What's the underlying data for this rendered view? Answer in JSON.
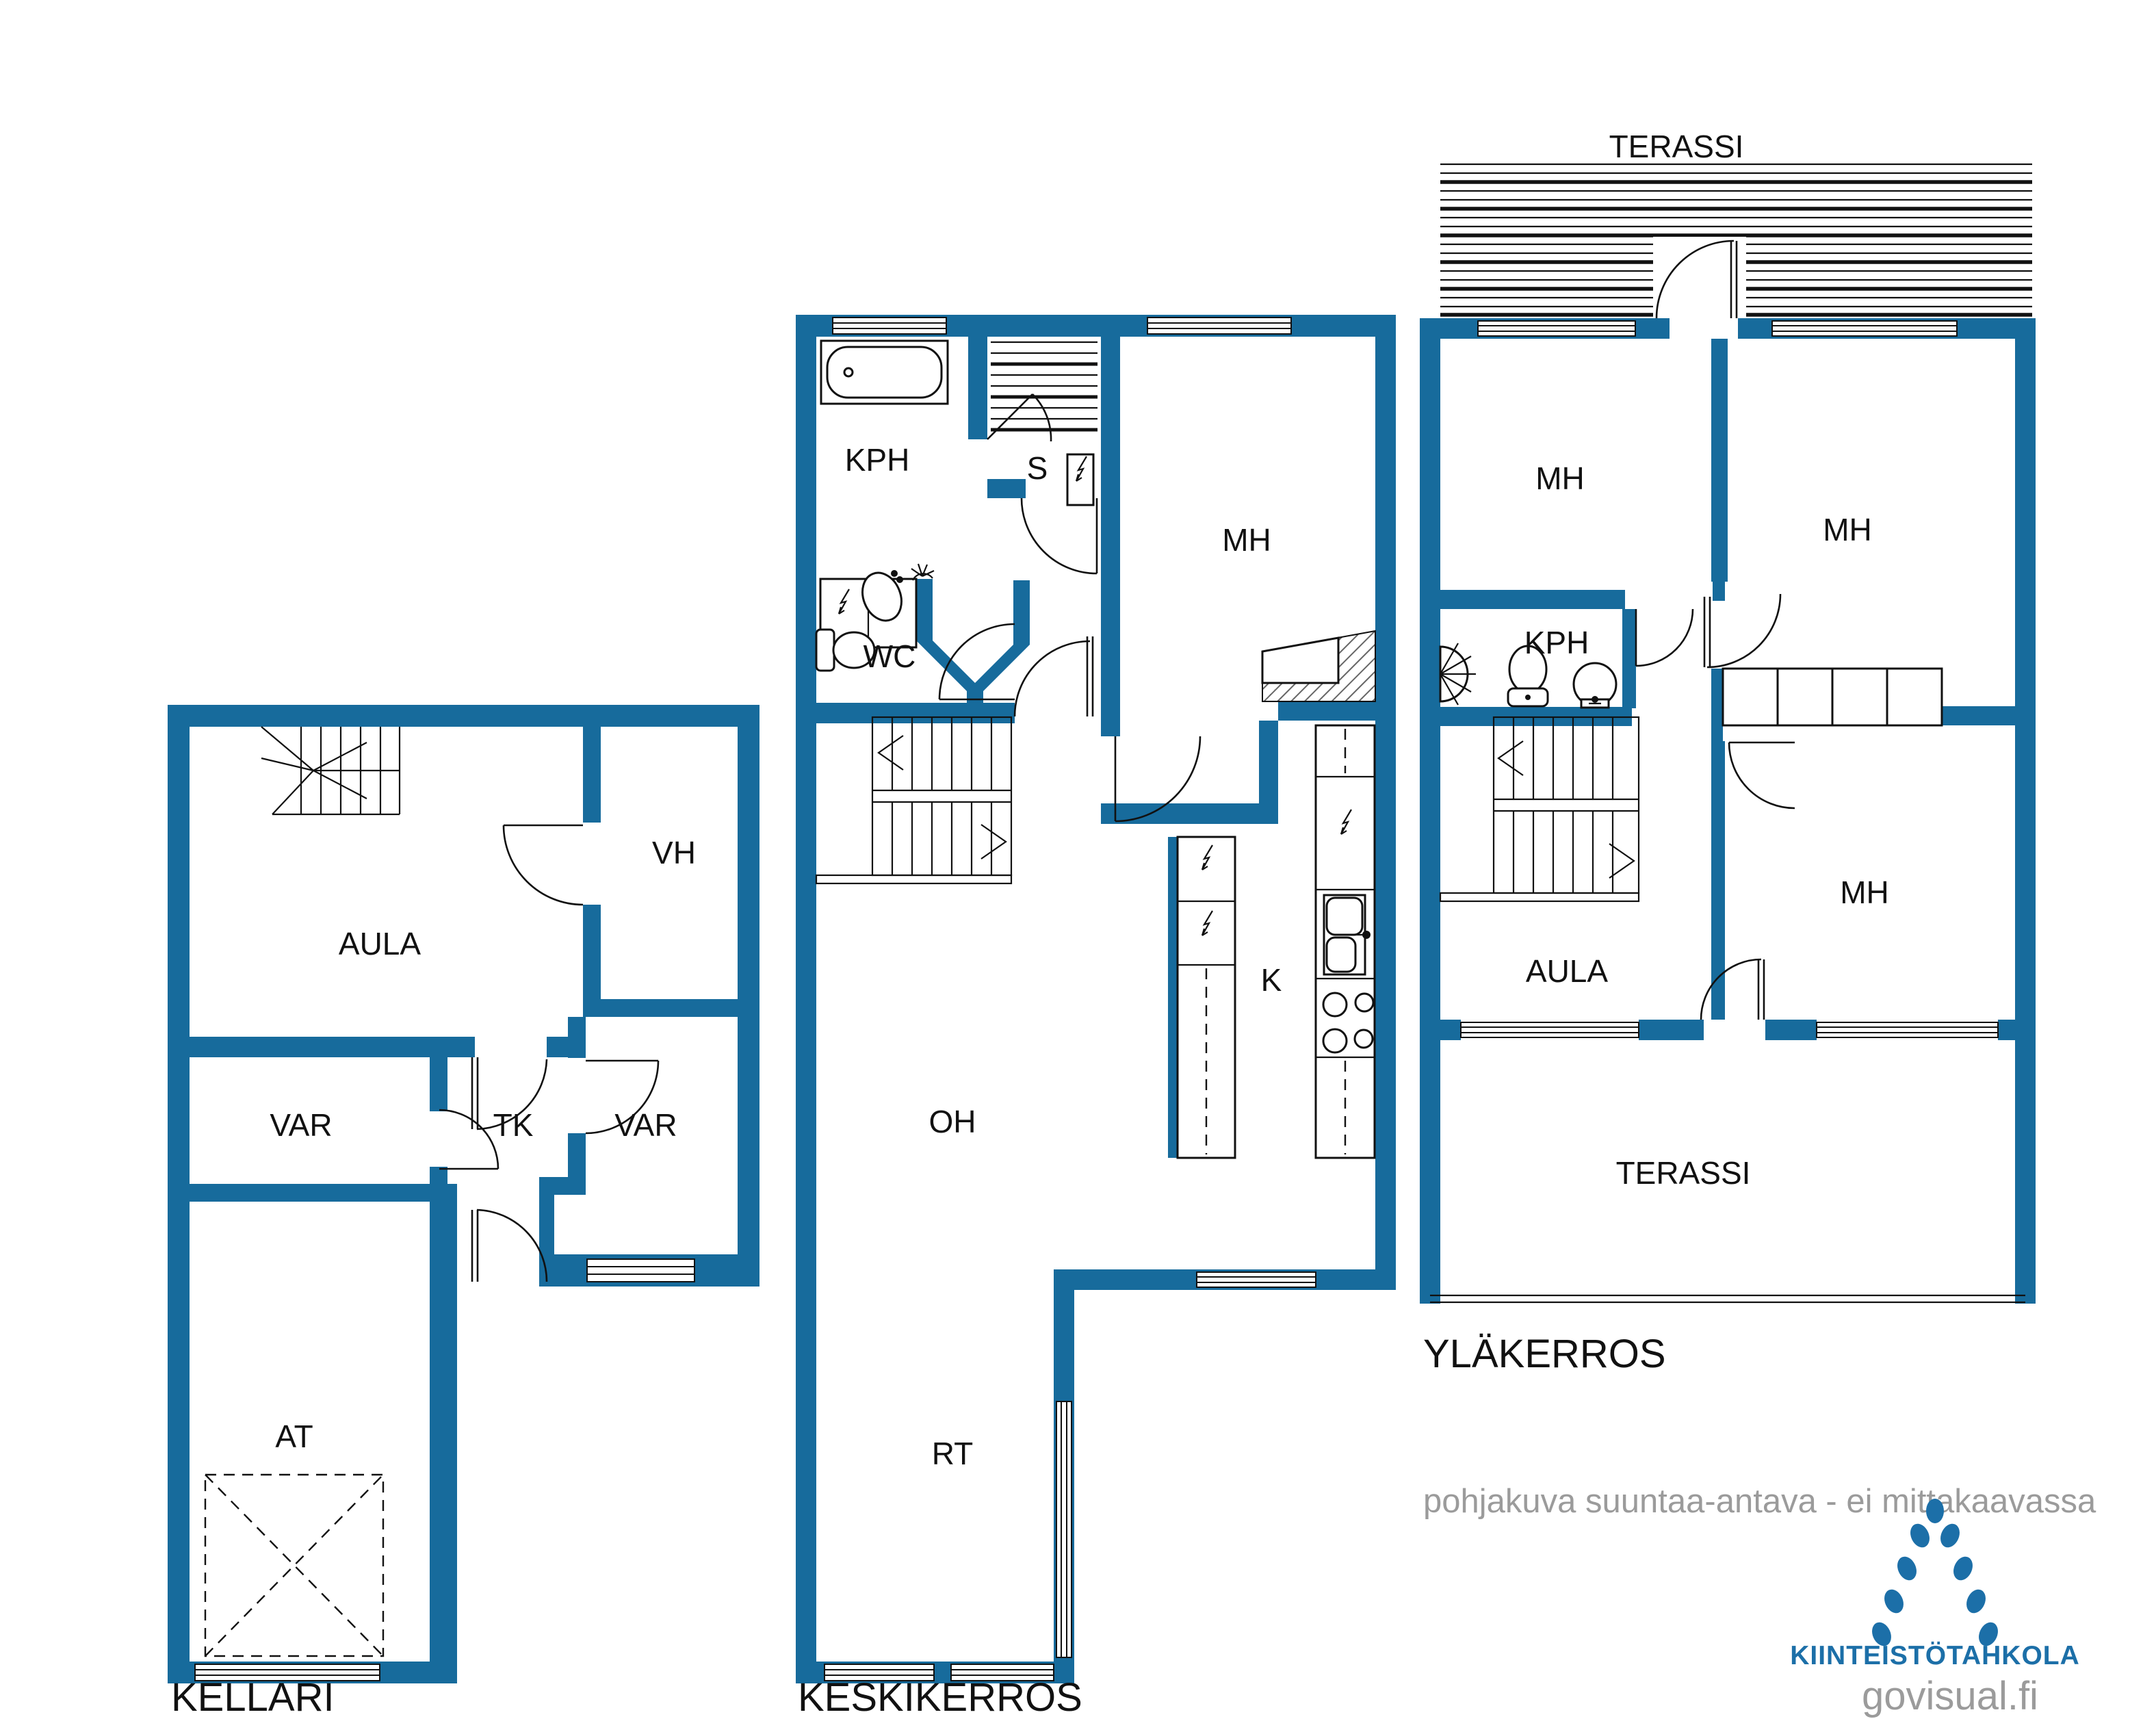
{
  "colors": {
    "wall": "#176B9C",
    "logo_blue": "#1C6FA8",
    "muted_text": "#9B9B9B",
    "line": "#111111"
  },
  "floors": {
    "kellari": {
      "title": "KELLARI",
      "rooms": [
        "AULA",
        "VH",
        "VAR",
        "TK",
        "VAR",
        "AT"
      ]
    },
    "keskikerros": {
      "title": "KESKIKERROS",
      "rooms": [
        "KPH",
        "S",
        "MH",
        "WC",
        "OH",
        "K",
        "RT"
      ]
    },
    "ylakerros": {
      "title": "YLÄKERROS",
      "rooms": [
        "TERASSI",
        "MH",
        "MH",
        "KPH",
        "MH",
        "AULA",
        "TERASSI"
      ]
    }
  },
  "footer": {
    "disclaimer": "pohjakuva suuntaa-antava - ei mittakaavassa",
    "brand": "KIINTEISTÖTAHKOLA",
    "watermark": "govisual.fi"
  }
}
